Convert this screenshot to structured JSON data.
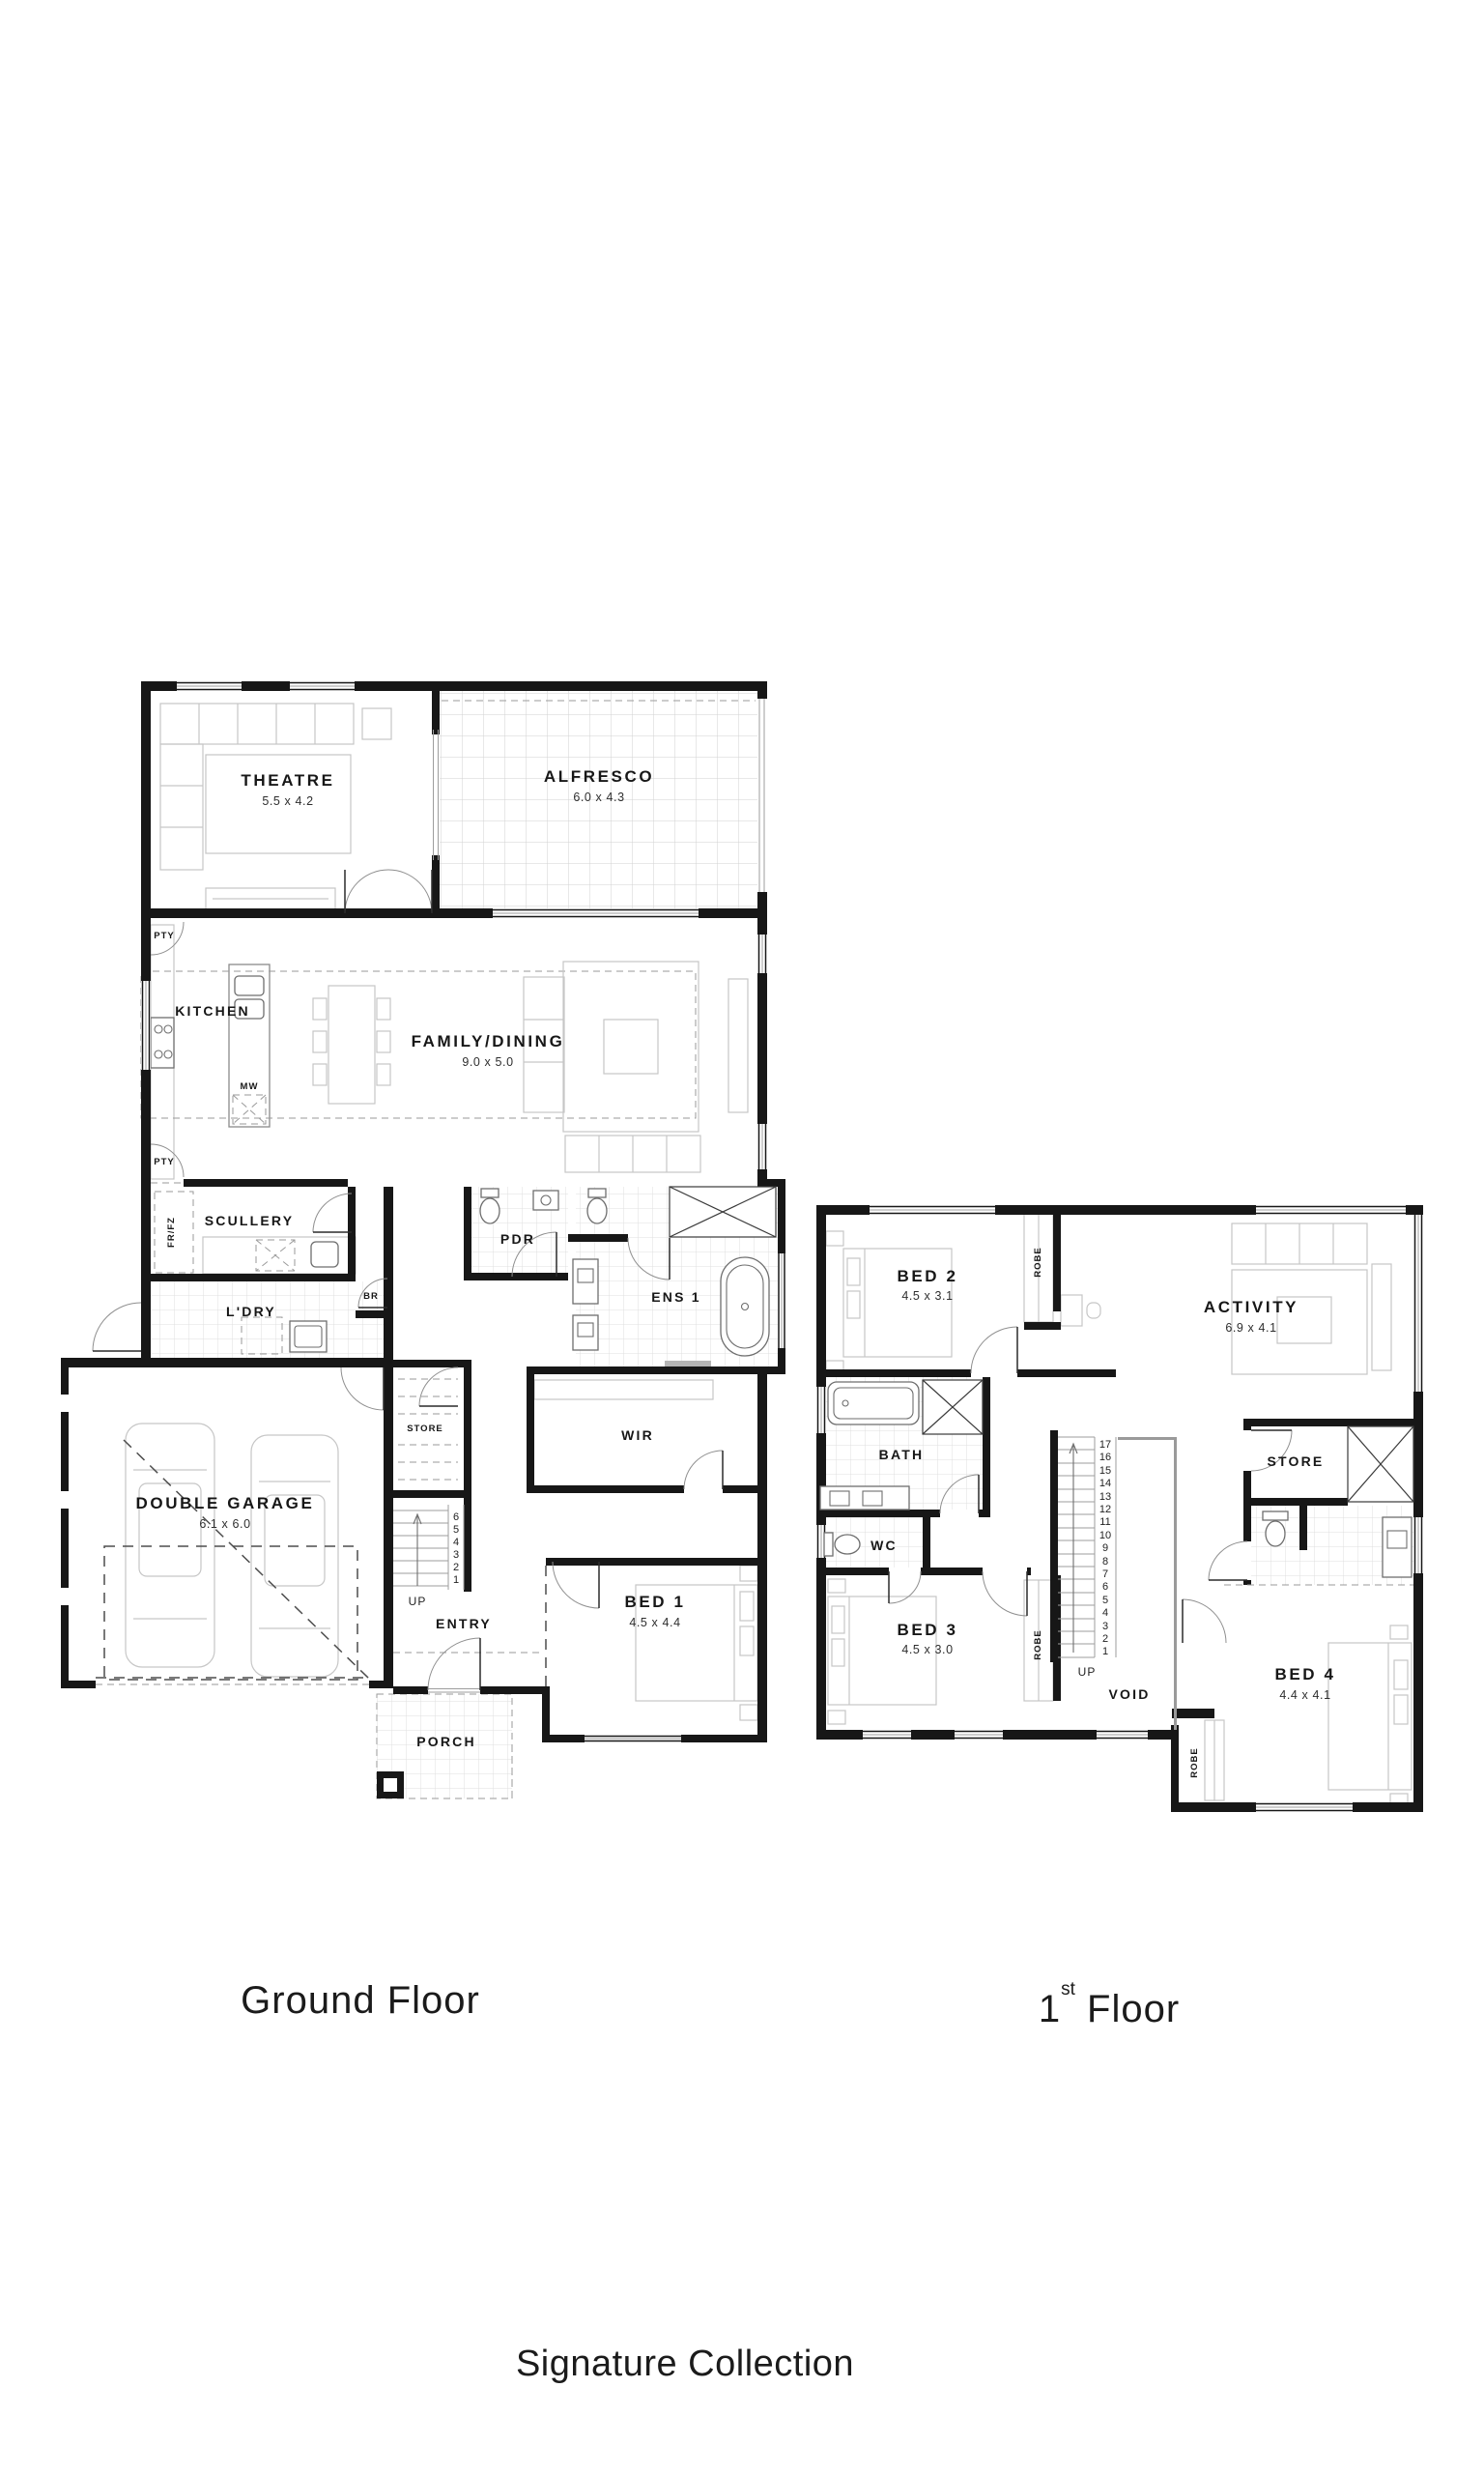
{
  "titles": {
    "ground": "Ground Floor",
    "first_num": "1",
    "first_sup": "st",
    "first_rest": " Floor",
    "collection": "Signature Collection"
  },
  "ground_floor": {
    "rooms": {
      "theatre": {
        "name": "THEATRE",
        "dims": "5.5 x 4.2"
      },
      "alfresco": {
        "name": "ALFRESCO",
        "dims": "6.0 x 4.3"
      },
      "kitchen": {
        "name": "KITCHEN"
      },
      "family_dining": {
        "name": "FAMILY/DINING",
        "dims": "9.0 x 5.0"
      },
      "scullery": {
        "name": "SCULLERY"
      },
      "pdr": {
        "name": "PDR"
      },
      "ens1": {
        "name": "ENS 1"
      },
      "ldry": {
        "name": "L'DRY"
      },
      "wir": {
        "name": "WIR"
      },
      "garage": {
        "name": "DOUBLE GARAGE",
        "dims": "6.1 x 6.0"
      },
      "store": {
        "name": "STORE"
      },
      "entry": {
        "name": "ENTRY"
      },
      "bed1": {
        "name": "BED 1",
        "dims": "4.5 x 4.4"
      },
      "porch": {
        "name": "PORCH"
      }
    },
    "labels": {
      "pty_upper": "PTY",
      "pty_lower": "PTY",
      "fr_fz": "FR/FZ",
      "mw": "MW",
      "br": "BR",
      "up": "UP"
    },
    "stairs": [
      "6",
      "5",
      "4",
      "3",
      "2",
      "1"
    ]
  },
  "first_floor": {
    "rooms": {
      "bed2": {
        "name": "BED 2",
        "dims": "4.5 x 3.1"
      },
      "activity": {
        "name": "ACTIVITY",
        "dims": "6.9 x 4.1"
      },
      "bath": {
        "name": "BATH"
      },
      "wc": {
        "name": "WC"
      },
      "store": {
        "name": "STORE"
      },
      "bed3": {
        "name": "BED 3",
        "dims": "4.5 x 3.0"
      },
      "void": {
        "name": "VOID"
      },
      "bed4": {
        "name": "BED 4",
        "dims": "4.4 x 4.1"
      }
    },
    "labels": {
      "robe_bed2": "ROBE",
      "robe_bed3": "ROBE",
      "robe_bed4": "ROBE",
      "up": "UP"
    },
    "stairs": [
      "17",
      "16",
      "15",
      "14",
      "13",
      "12",
      "11",
      "10",
      "9",
      "8",
      "7",
      "6",
      "5",
      "4",
      "3",
      "2",
      "1"
    ]
  }
}
